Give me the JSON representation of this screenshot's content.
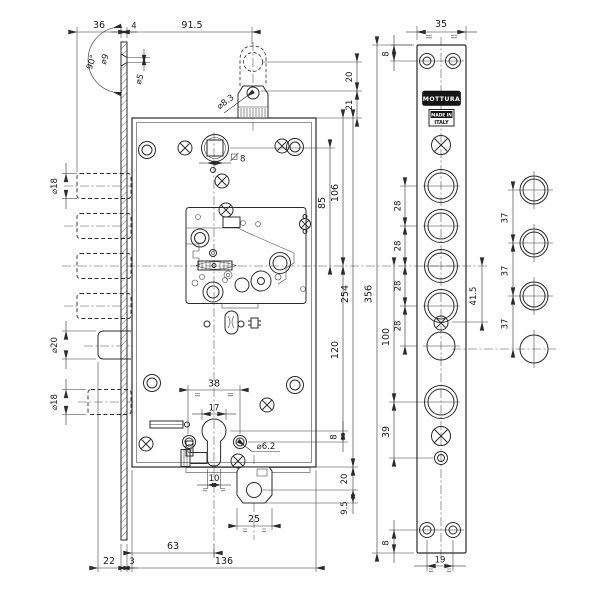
{
  "drawing": {
    "brand": "MOTTURA",
    "made_in_line1": "MADE IN",
    "made_in_line2": "ITALY"
  },
  "dims": {
    "bolt_throw": "36",
    "plate_thk_top": "4",
    "tab_axis": "91.5",
    "cs_angle": "90°",
    "cs_dia": "⌀9",
    "cs_pilot": "⌀5",
    "tab_hole": "⌀8.3",
    "tab_20": "20",
    "tab_21": "21",
    "follower_axis": "85",
    "top_to_axis": "106",
    "body_h": "254",
    "axis_cyl": "120",
    "cyl_8": "8",
    "bolt_dia": "⌀18",
    "latch_dia": "⌀20",
    "sq8": "8",
    "span38": "38",
    "cyl17": "17",
    "hole62": "⌀6.2",
    "cyl10": "10",
    "tab25": "25",
    "backset": "63",
    "body_w": "136",
    "latch_throw": "22",
    "plate_thk": "3",
    "btab_20": "20",
    "btab_95": "9.5",
    "fp_w": "35",
    "fp_edge8": "8",
    "sp28": "28",
    "fp_len": "356",
    "axis_100": "100",
    "d39": "39",
    "d19": "19",
    "d415": "41.5",
    "sp37": "37"
  }
}
